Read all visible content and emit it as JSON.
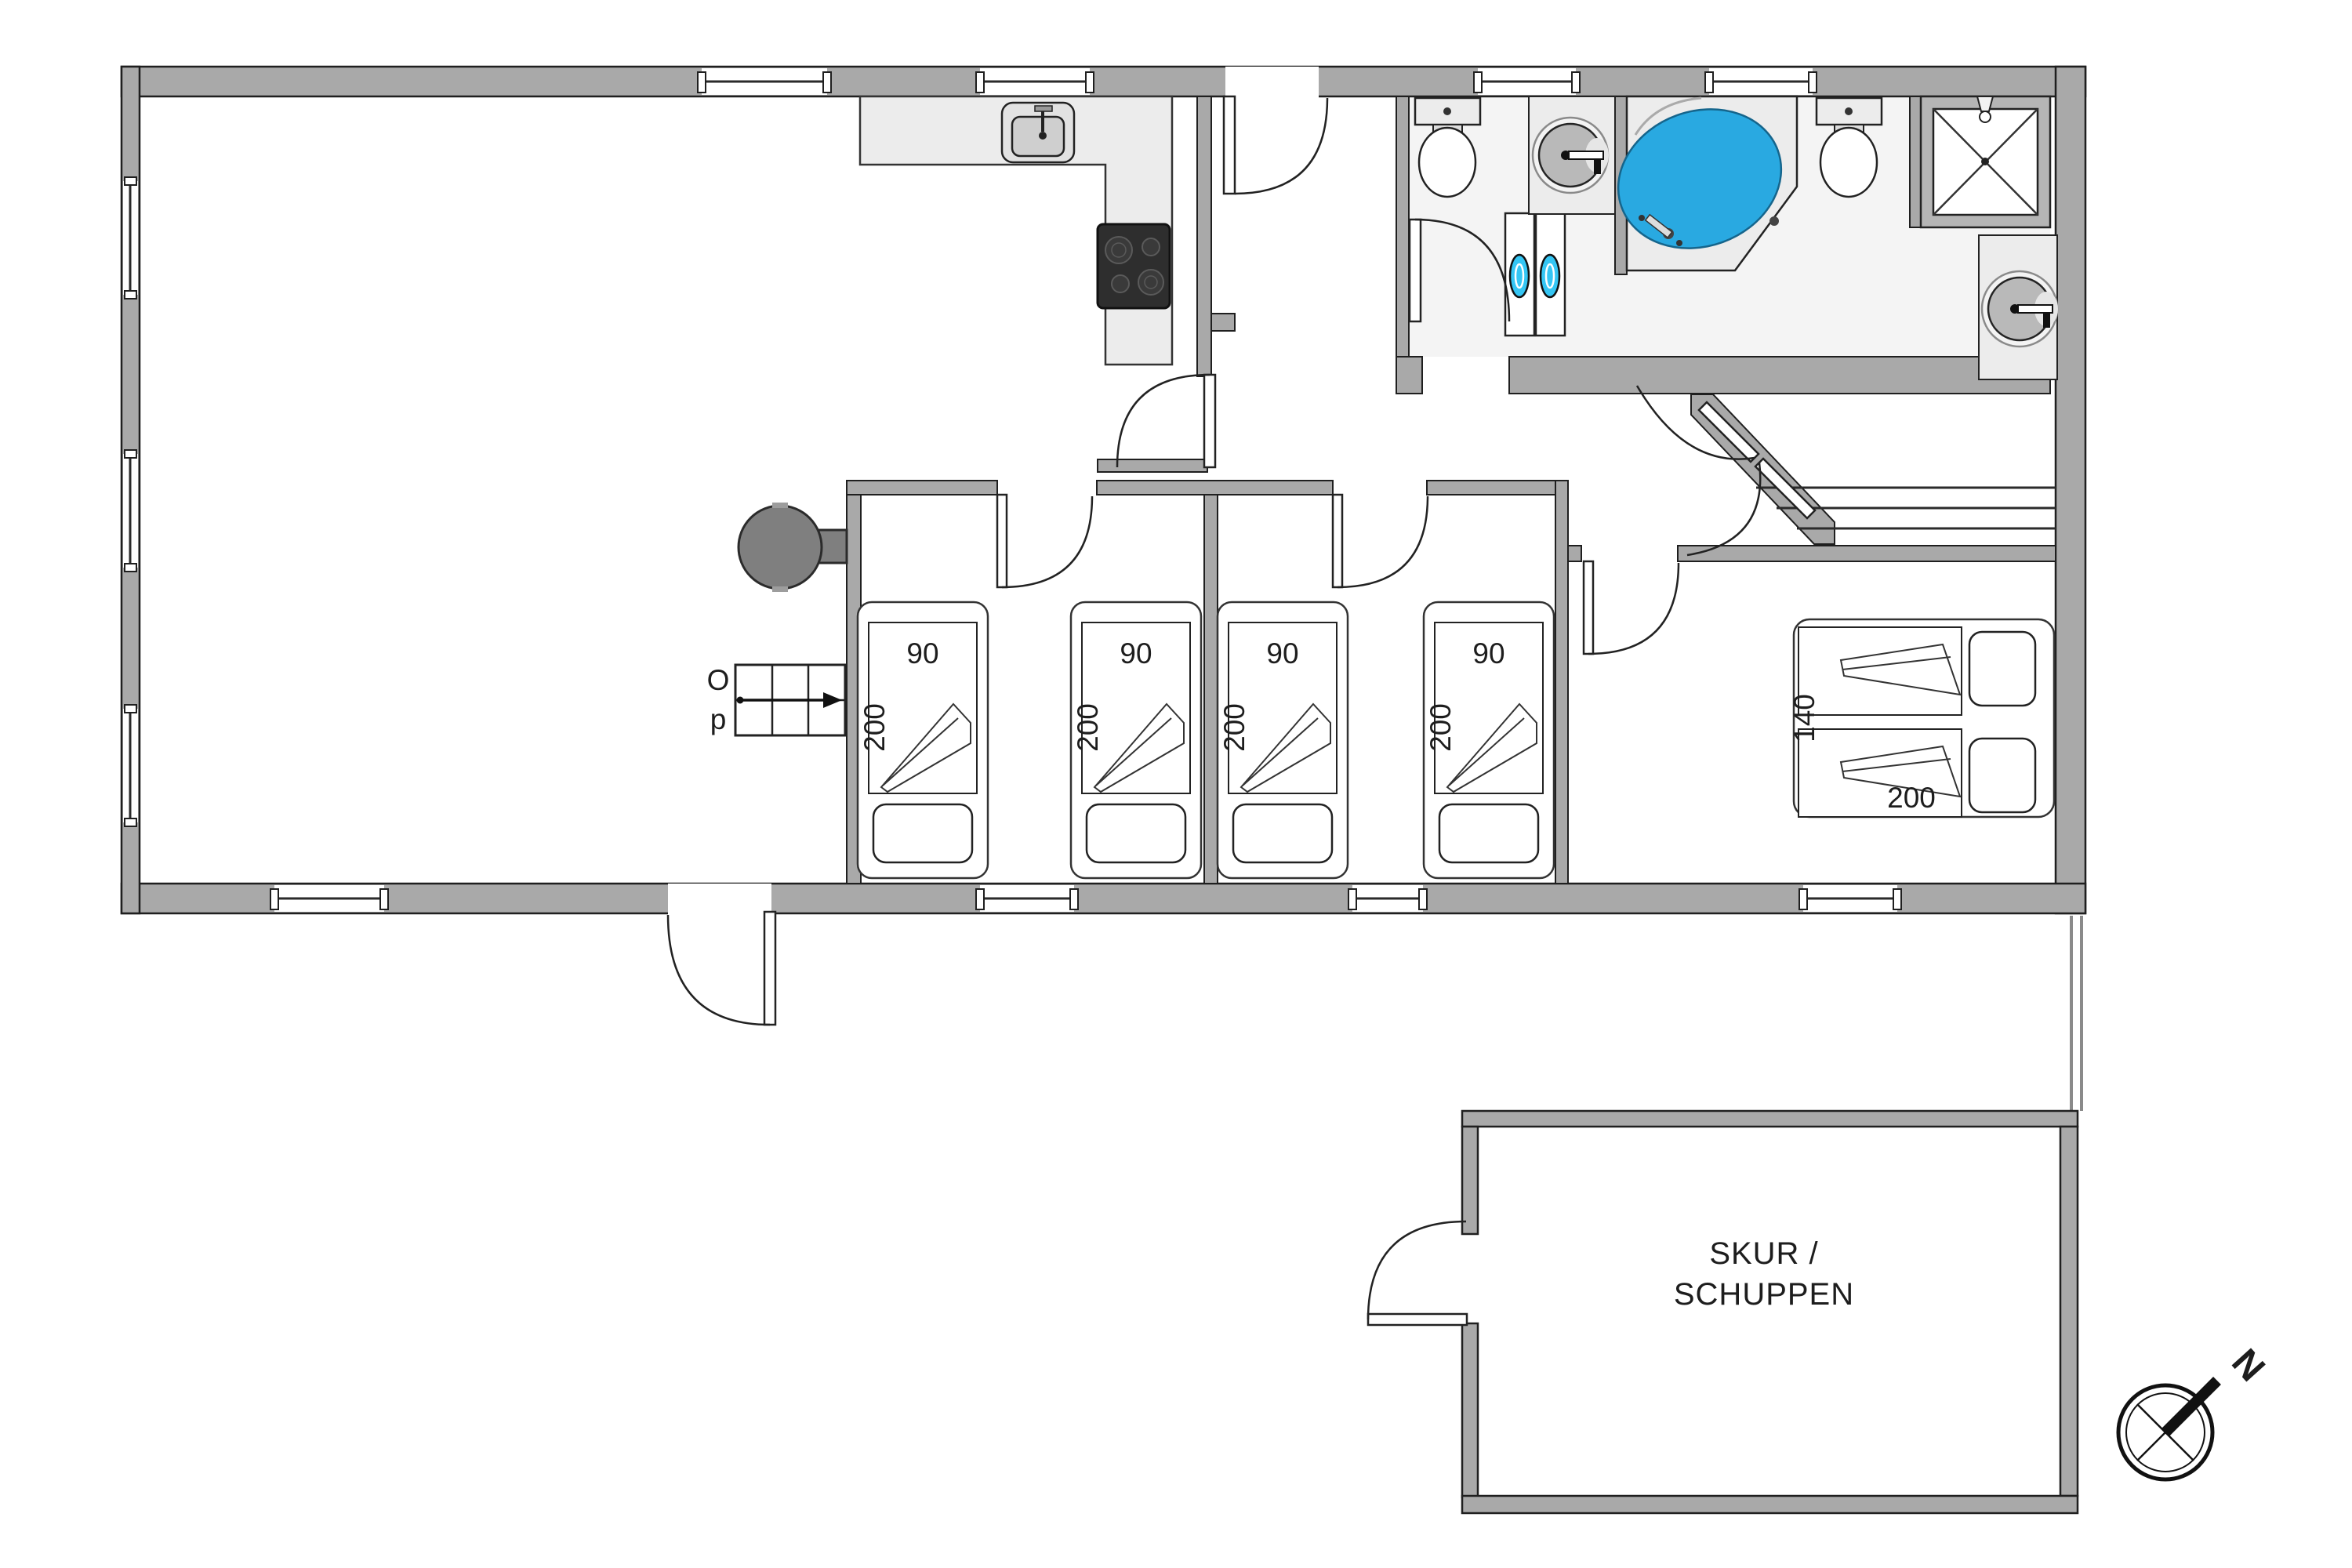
{
  "plan": {
    "type": "floor-plan",
    "language": "da/de",
    "rooms": {
      "shed": {
        "line1": "SKUR /",
        "line2": "SCHUPPEN"
      }
    },
    "beds": {
      "singles": [
        {
          "width_label": "90",
          "length_label": "200"
        },
        {
          "width_label": "90",
          "length_label": "200"
        },
        {
          "width_label": "90",
          "length_label": "200"
        },
        {
          "width_label": "90",
          "length_label": "200"
        }
      ],
      "double": {
        "width_label": "140",
        "length_label": "200"
      }
    },
    "stairs": {
      "label_line1": "O",
      "label_line2": "p",
      "meaning": "Op (up)"
    },
    "compass": {
      "north_label": "N"
    },
    "colors": {
      "wall": "#a9a9a9",
      "bathtub_blue": "#29a9e1",
      "washer_door_cyan": "#35c6f4",
      "cooktop_dark": "#2e2e2e",
      "wood_stove_gray": "#7f7f7f",
      "fixture_light": "#ececec",
      "bathroom_floor": "#f4f4f4"
    }
  }
}
